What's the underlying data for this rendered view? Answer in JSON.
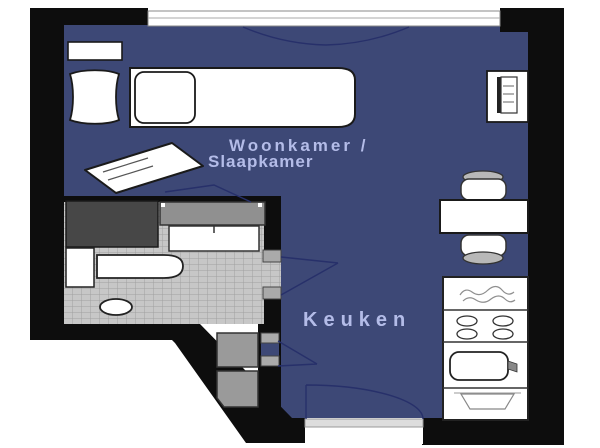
{
  "floorplan": {
    "rooms": {
      "living_bedroom": {
        "label_line1": "Woonkamer /",
        "label_line2": "Slaapkamer"
      },
      "kitchen": {
        "label": "Keuken"
      }
    },
    "colors": {
      "floor": "#3d4876",
      "wall": "#0d0d0d",
      "tile": "#c7c7c7",
      "tile_grid": "#a0a0a0",
      "label_text": "#b4bce8",
      "line": "#27306a",
      "fixture_fill": "#ffffff",
      "fixture_stroke": "#1a1a1a"
    }
  }
}
